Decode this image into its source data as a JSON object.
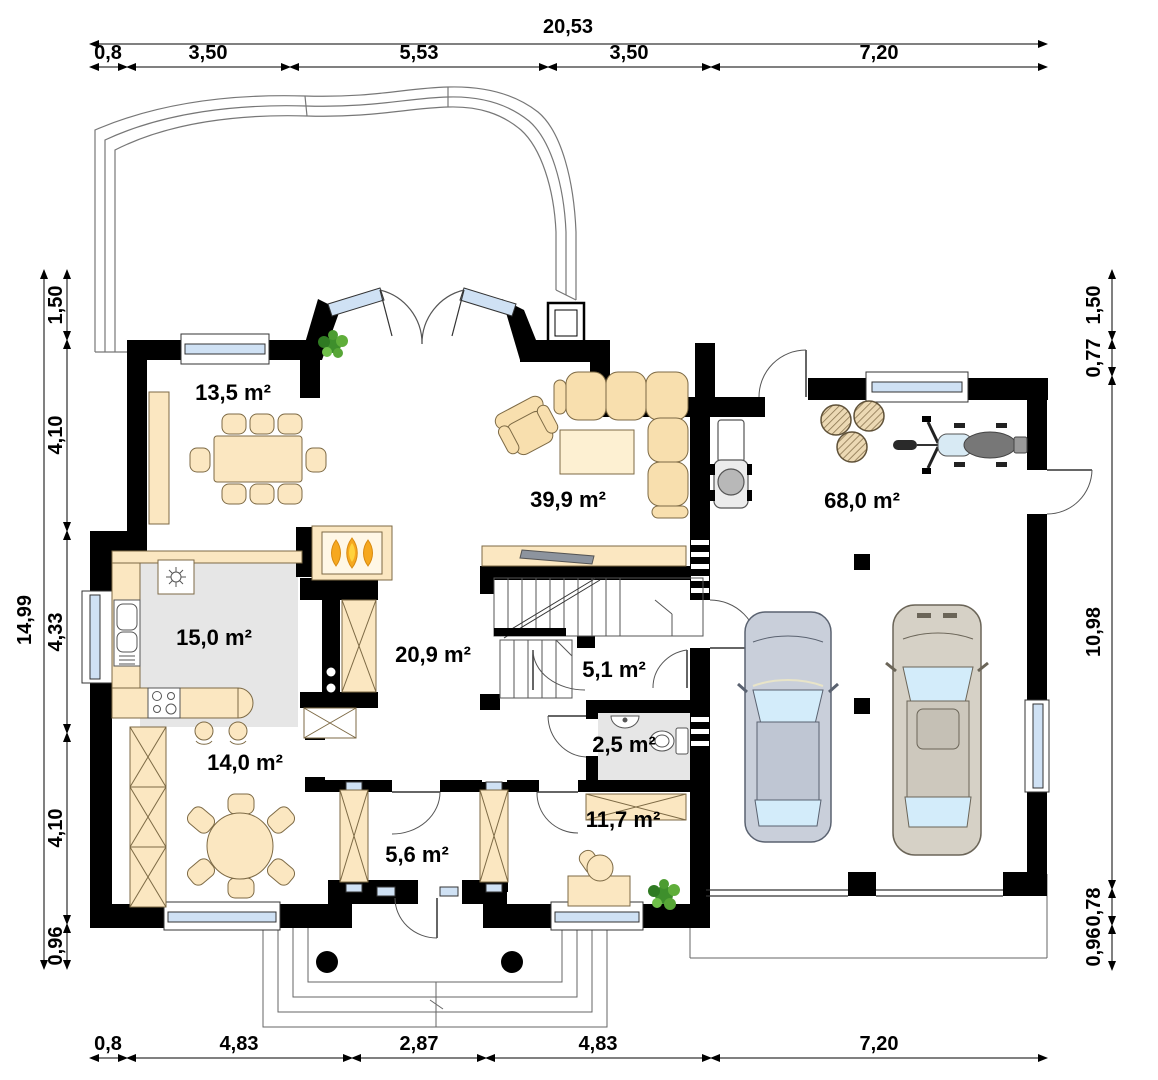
{
  "plan": {
    "title": "house-ground-floor-plan",
    "rooms": [
      {
        "name": "dining-room",
        "area": "13,5 m²"
      },
      {
        "name": "living-room",
        "area": "39,9 m²"
      },
      {
        "name": "garage",
        "area": "68,0 m²"
      },
      {
        "name": "kitchen",
        "area": "15,0 m²"
      },
      {
        "name": "hall",
        "area": "20,9 m²"
      },
      {
        "name": "vestibule",
        "area": "5,1 m²"
      },
      {
        "name": "wc",
        "area": "2,5 m²"
      },
      {
        "name": "tavern-room",
        "area": "14,0 m²"
      },
      {
        "name": "corridor",
        "area": "5,6 m²"
      },
      {
        "name": "office",
        "area": "11,7 m²"
      }
    ],
    "dimensions": {
      "top_total": "20,53",
      "top": [
        "0,8",
        "3,50",
        "5,53",
        "3,50",
        "7,20"
      ],
      "bottom": [
        "0,8",
        "4,83",
        "2,87",
        "4,83",
        "7,20"
      ],
      "left_total": "14,99",
      "left": [
        "1,50",
        "4,10",
        "4,33",
        "4,10",
        "0,96"
      ],
      "right": [
        "1,50",
        "0,77",
        "10,98",
        "0,78",
        "0,96"
      ]
    },
    "colors": {
      "wall": "#000000",
      "furniture": "#fbe7c1",
      "floor_gray": "#e6e6e6",
      "window_glass": "#cfe1f4",
      "flame_orange": "#f6a81f",
      "flame_yellow": "#ffd23e",
      "plant_green": "#4e9a2e",
      "car_left": "#c9cfda",
      "car_right": "#d6d1c6",
      "moto_tank": "#d8eaf4"
    }
  }
}
